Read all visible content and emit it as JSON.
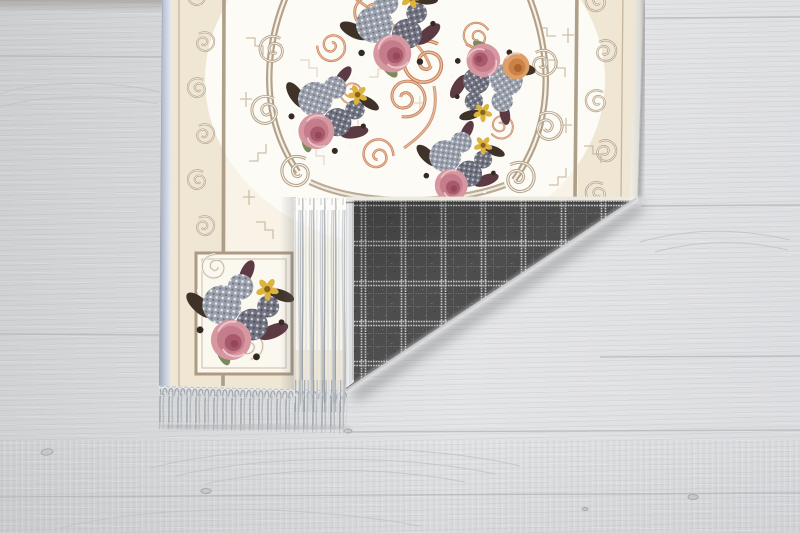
{
  "scene": {
    "type": "product-photo",
    "description": "Cream floral baroque area rug with pink roses, copper scrollwork and taupe ornament borders, its corner folded over to reveal a dark gray plaid woven backing, with light gray fringe tassels, lying on a whitewashed light gray wooden plank floor",
    "objects": {
      "floor": "light gray wooden plank floor with subtle grain, seams and knots",
      "rug_front": "cream rug face with ivory center field, floral bouquets and scroll borders",
      "rug_backing": "dark gray tartan plaid woven backing shown on folded corner",
      "fringe": "light gray tasseled fringe on rug edge and folded flap edge",
      "bouquets": "pink roses, peach rose, yellow blossoms, gray-lilac hydrangeas, dark plum foliage"
    }
  },
  "colors": {
    "floor_base": "#dadbdc",
    "rug_cream": "#efe6d3",
    "rug_field": "#fdfbf5",
    "binding_blue": "#c3cbdb",
    "taupe": "#b4a189",
    "taupe_dark": "#9c8a73",
    "copper": "#c8845f",
    "copper_light": "#ecc3a4",
    "rose_pink": "#d697a1",
    "rose_deep": "#a85a6b",
    "peach": "#dd9f67",
    "yellow": "#ddb33f",
    "lilac_light": "#9aa0ac",
    "lilac_dark": "#70727f",
    "foliage": "#3f3329",
    "plum": "#5c3a44",
    "leaf_green": "#7b8a5e",
    "plaid_base": "#4e4e4f",
    "plaid_line": "#d9d9db",
    "fringe_light": "#d4d7da",
    "fringe_dark": "#9aa0a6",
    "shadow": "#6b6e74"
  }
}
